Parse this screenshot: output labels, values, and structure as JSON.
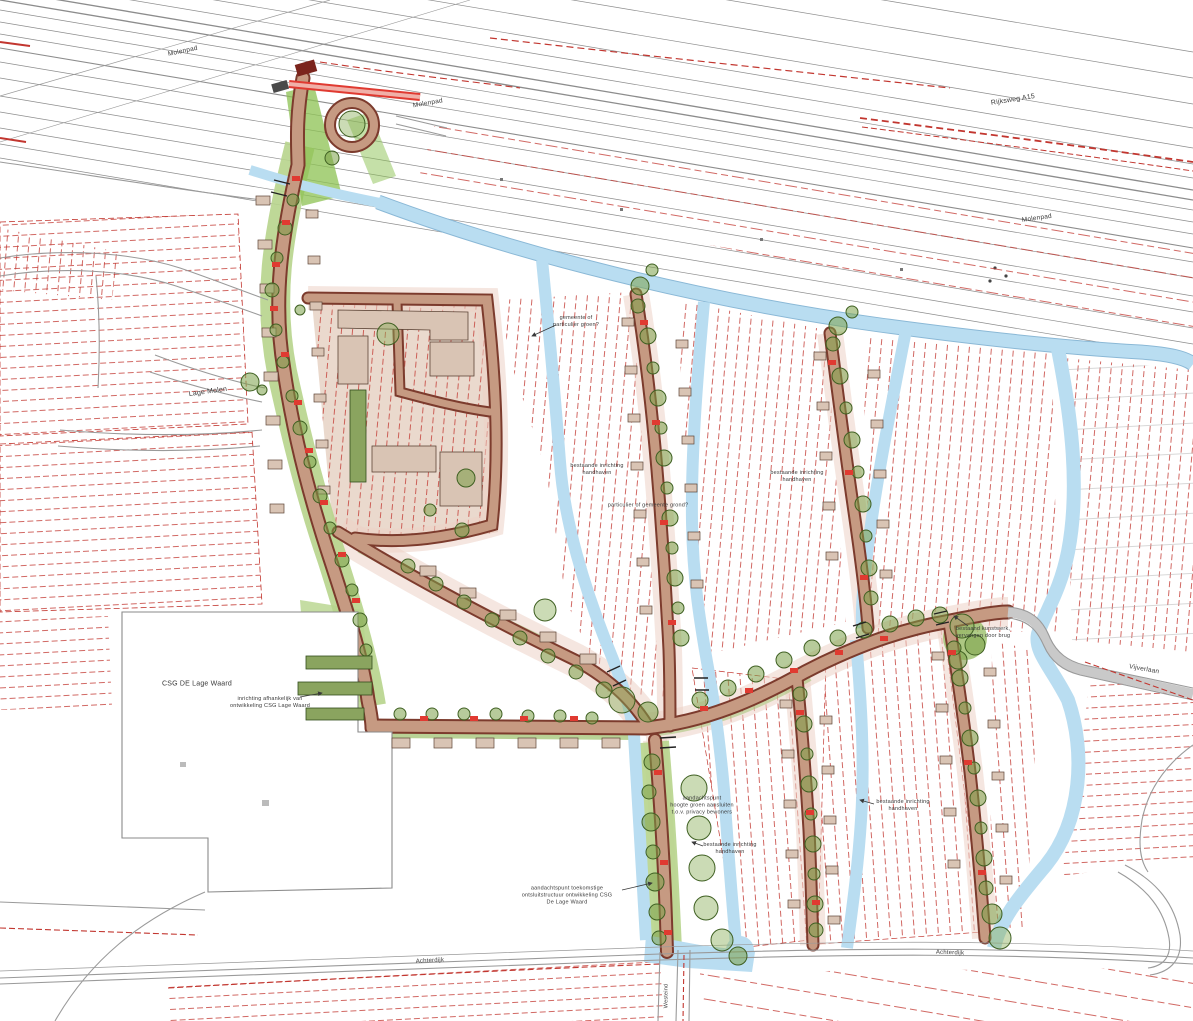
{
  "palette": {
    "water": "#b9ddf1",
    "water_edge": "#8ab8d6",
    "parcel_red": "#c2362f",
    "accent_red": "#e03a31",
    "road_fill": "#c69a82",
    "road_edge": "#7c3b2d",
    "green_strip": "#b7d48c",
    "green_bright": "#8cc152",
    "tree_fill": "#7ca048",
    "tree_edge": "#3f6022",
    "building_tan": "#d9c4b4",
    "garage_green": "#8aa45f",
    "gray_line": "#8c8c8c",
    "label_color": "#3a3a3a"
  },
  "labels": [
    {
      "name": "street-label-molenpad-west",
      "text": "Molenpad",
      "x": 183,
      "y": 52,
      "rot": -12,
      "size": 6.5
    },
    {
      "name": "street-label-molenpad-center",
      "text": "Molenpad",
      "x": 428,
      "y": 104,
      "rot": -10,
      "size": 6.5
    },
    {
      "name": "street-label-rijksweg-a15",
      "text": "Rijksweg A15",
      "x": 1013,
      "y": 100,
      "rot": -9,
      "size": 7
    },
    {
      "name": "street-label-molenpad-east",
      "text": "Molenpad",
      "x": 1037,
      "y": 219,
      "rot": -8,
      "size": 6.5
    },
    {
      "name": "street-label-lage-molen",
      "text": "Lage Molen",
      "x": 208,
      "y": 392,
      "rot": -8,
      "size": 7
    },
    {
      "name": "area-label-csg-de-lage-waard",
      "text": "CSG DE Lage Waard",
      "x": 197,
      "y": 684,
      "rot": 0,
      "size": 7
    },
    {
      "name": "note-inrichting-afhankelijk",
      "text": "inrichting afhankelijk van\nontwikkeling CSG Lage Waard",
      "x": 270,
      "y": 703,
      "rot": 0,
      "size": 5.5
    },
    {
      "name": "note-gemeente-of-particulier",
      "text": "gemeente of\nparticulier groen?",
      "x": 576,
      "y": 322,
      "rot": 0,
      "size": 5.5
    },
    {
      "name": "note-bestaande-inrichting-1",
      "text": "bestaande inrichting\nhandhaven",
      "x": 597,
      "y": 470,
      "rot": 0,
      "size": 5.5
    },
    {
      "name": "note-particulier-of-gemeente",
      "text": "particulier of gemeente grond?",
      "x": 648,
      "y": 506,
      "rot": 0,
      "size": 5.5
    },
    {
      "name": "note-bestaande-inrichting-2",
      "text": "bestaande inrichting\nhandhaven",
      "x": 797,
      "y": 477,
      "rot": 0,
      "size": 5.5
    },
    {
      "name": "note-bestaand-kunstwerk",
      "text": "bestaand kunstwerk,\nvervangen door brug",
      "x": 983,
      "y": 633,
      "rot": 0,
      "size": 5.5
    },
    {
      "name": "street-label-vijverlaan",
      "text": "Vijverlaan",
      "x": 1144,
      "y": 670,
      "rot": 10,
      "size": 6.5
    },
    {
      "name": "note-aandachtspunt-privacy",
      "text": "aandachtspunt\nhoogte groen aansluiten\nt.o.v. privacy bewoners",
      "x": 702,
      "y": 806,
      "rot": 0,
      "size": 5.5
    },
    {
      "name": "note-bestaande-inrichting-3",
      "text": "bestaande inrichting\nhandhaven",
      "x": 903,
      "y": 806,
      "rot": 0,
      "size": 5.5
    },
    {
      "name": "note-bestaande-inrichting-4",
      "text": "bestaande inrichting\nhandhaven",
      "x": 730,
      "y": 849,
      "rot": 0,
      "size": 5.5
    },
    {
      "name": "note-aandachtspunt-ontsluiting",
      "text": "aandachtspunt toekomstige\nontsluitstructuur ontwikkeling CSG\nDe Lage Waard",
      "x": 567,
      "y": 896,
      "rot": 0,
      "size": 5.5
    },
    {
      "name": "street-label-achterdijk-west",
      "text": "Achterdijk",
      "x": 430,
      "y": 962,
      "rot": -3,
      "size": 6
    },
    {
      "name": "street-label-achterdijk-east",
      "text": "Achterdijk",
      "x": 950,
      "y": 954,
      "rot": 2,
      "size": 6
    },
    {
      "name": "street-label-westeind",
      "text": "Westeind",
      "x": 667,
      "y": 996,
      "rot": -90,
      "size": 5.5
    }
  ]
}
